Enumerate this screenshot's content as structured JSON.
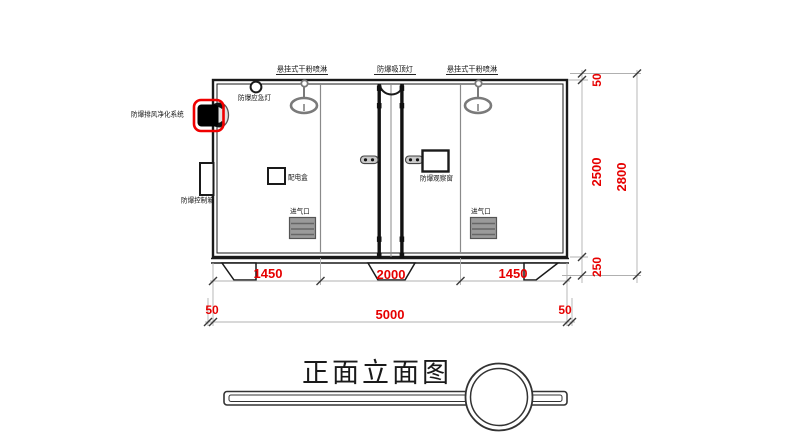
{
  "drawing_title": "正面立面图",
  "equipment_labels": {
    "sprinkler_left": "悬挂式干粉喷淋",
    "ceiling_lamp": "防爆吸顶灯",
    "sprinkler_right": "悬挂式干粉喷淋",
    "emergency_lamp": "防爆应急灯",
    "purification_system": "防爆排风净化系统",
    "control_box": "防爆控制箱",
    "power_box": "配电盒",
    "observation_window": "防爆观察窗",
    "air_inlet_left": "进气口",
    "air_inlet_right": "进气口"
  },
  "dimensions": {
    "top_right_offset": "50",
    "height_inner": "2500",
    "base_height": "250",
    "height_overall": "2800",
    "bay_left": "1450",
    "bay_center": "2000",
    "bay_right": "1450",
    "overhang_left": "50",
    "width_overall": "5000",
    "overhang_right": "50"
  },
  "colors": {
    "dimension_text": "#e60000",
    "highlight_red": "#f00000",
    "primary_line": "#1a1a1a",
    "secondary_line": "#8a8a8a"
  }
}
